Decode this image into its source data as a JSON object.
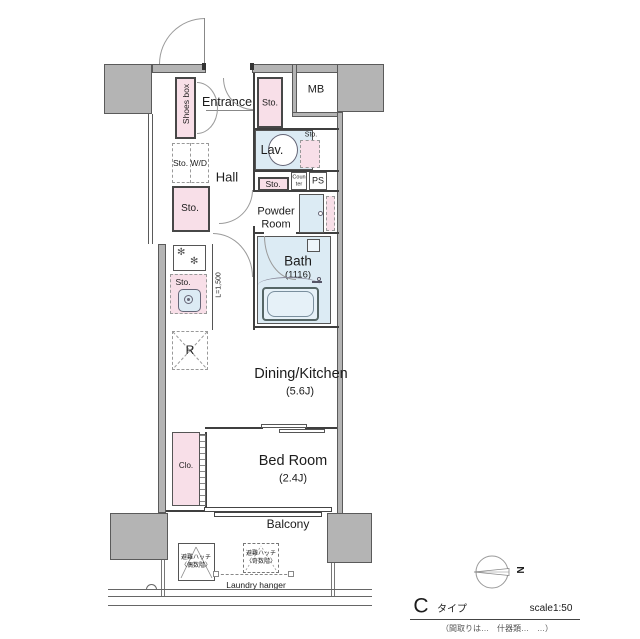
{
  "colors": {
    "wall_gray": "#b4b4b4",
    "storage_pink": "#f8dfe8",
    "wet_blue": "#dcebf4"
  },
  "plan": {
    "entrance": "Entrance",
    "shoes_box": "Shoes box",
    "sto": "Sto.",
    "sto_wd": "Sto. W/D",
    "mb": "MB",
    "lav": "Lav.",
    "hall": "Hall",
    "counter_l1": "Coun",
    "counter_l2": "ter",
    "ps": "PS",
    "powder_l1": "Powder",
    "powder_l2": "Room",
    "bath": "Bath",
    "bath_size": "(1116)",
    "dining_kitchen": "Dining/Kitchen",
    "dining_kitchen_size": "(5.6J)",
    "bed_room": "Bed Room",
    "bed_room_size": "(2.4J)",
    "clo": "Clo.",
    "fridge": "R",
    "counter_length": "L=1,500"
  },
  "balcony": {
    "label": "Balcony",
    "laundry_hanger": "Laundry hanger",
    "hatch_even_l1": "避難ハッチ",
    "hatch_even_l2": "〈偶数階〉",
    "hatch_odd_l1": "避難ハッチ",
    "hatch_odd_l2": "〈奇数階〉"
  },
  "compass": {
    "north": "N"
  },
  "titleblock": {
    "type_letter": "C",
    "type_suffix": "タイプ",
    "scale": "scale1:50",
    "footnote": "（間取りは…　什器類…　…）"
  }
}
